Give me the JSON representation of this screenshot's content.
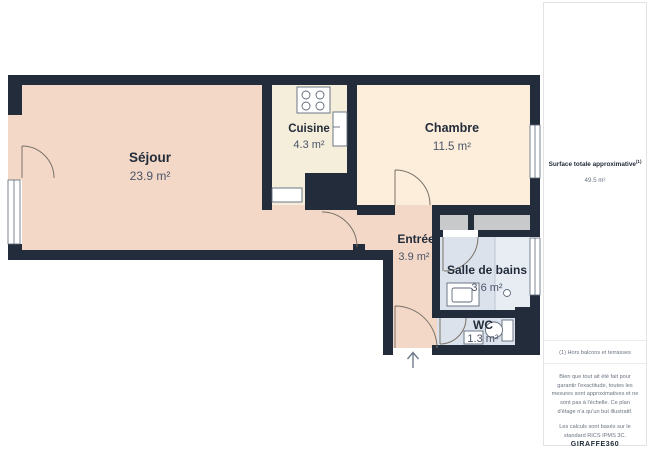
{
  "plan": {
    "rooms": [
      {
        "name": "Séjour",
        "area": "23.9 m²"
      },
      {
        "name": "Cuisine",
        "area": "4.3 m²"
      },
      {
        "name": "Chambre",
        "area": "11.5 m²"
      },
      {
        "name": "Entrée",
        "area": "3.9 m²"
      },
      {
        "name": "Salle de bains",
        "area": "3.6 m²"
      },
      {
        "name": "WC",
        "area": "1.3 m²"
      }
    ],
    "colors": {
      "wall": "#232c3a",
      "sejour": "#f3d8c7",
      "cuisine": "#f5eedb",
      "chambre": "#fceedb",
      "bathroom": "#dbe2ec",
      "shower": "#e8edf4",
      "closet": "#c7c9ca",
      "label": "#232c3a",
      "value": "#4a5468"
    }
  },
  "sidebar": {
    "total_label": "Surface totale approximative",
    "total_sup": "(1)",
    "total_value": "49.5 m²",
    "footnote": "(1) Hors balcons et terrasses",
    "disclaimer": "Bien que tout ait été fait pour garantir l'exactitude, toutes les mesures sont approximatives et ne sont pas à l'échelle. Ce plan d'étage n'a qu'un but illustratif.",
    "standard": "Les calculs sont basés sur le standard RICS IPMS 3C.",
    "brand_name": "GIRAFFE",
    "brand_suffix": "360"
  }
}
